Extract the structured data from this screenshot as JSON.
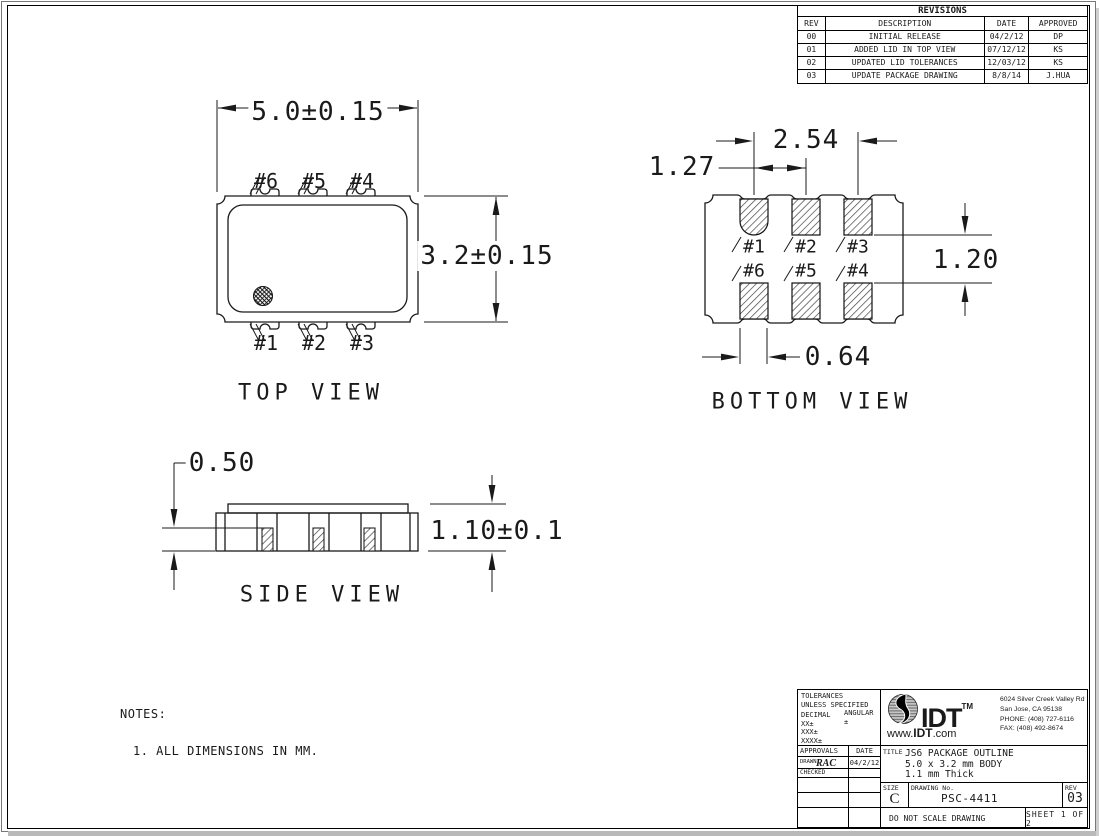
{
  "revisions": {
    "title": "REVISIONS",
    "headers": {
      "rev": "REV",
      "description": "DESCRIPTION",
      "date": "DATE",
      "approved": "APPROVED"
    },
    "rows": [
      {
        "rev": "00",
        "description": "INITIAL RELEASE",
        "date": "04/2/12",
        "approved": "DP"
      },
      {
        "rev": "01",
        "description": "ADDED LID IN TOP VIEW",
        "date": "07/12/12",
        "approved": "KS"
      },
      {
        "rev": "02",
        "description": "UPDATED LID TOLERANCES",
        "date": "12/03/12",
        "approved": "KS"
      },
      {
        "rev": "03",
        "description": "UPDATE PACKAGE DRAWING",
        "date": "8/8/14",
        "approved": "J.HUA"
      }
    ]
  },
  "views": {
    "top": {
      "label": "TOP VIEW",
      "dim_width": "5.0±0.15",
      "dim_height": "3.2±0.15",
      "pins_top": [
        "#6",
        "#5",
        "#4"
      ],
      "pins_bottom": [
        "#1",
        "#2",
        "#3"
      ]
    },
    "bottom": {
      "label": "BOTTOM VIEW",
      "dim_pitch_full": "2.54",
      "dim_pitch_half": "1.27",
      "dim_row_gap": "1.20",
      "dim_pad_width": "0.64",
      "pins_row1": [
        "#1",
        "#2",
        "#3"
      ],
      "pins_row2": [
        "#6",
        "#5",
        "#4"
      ]
    },
    "side": {
      "label": "SIDE VIEW",
      "dim_standoff": "0.50",
      "dim_height": "1.10±0.1"
    }
  },
  "notes": {
    "heading": "NOTES:",
    "item1": "1. ALL DIMENSIONS IN MM."
  },
  "title_block": {
    "tolerances": {
      "line1": "TOLERANCES",
      "line2": "UNLESS SPECIFIED",
      "decimal_label": "DECIMAL",
      "angular_label": "ANGULAR",
      "angular_value": "±",
      "row1": "XX±",
      "row2": "XXX±",
      "row3": "XXXX±"
    },
    "approvals": {
      "header": "APPROVALS",
      "date_header": "DATE",
      "drawn_label": "DRAWN",
      "drawn_signature": "RAC",
      "drawn_date": "04/2/12",
      "checked_label": "CHECKED"
    },
    "company": {
      "logo_text": "IDT",
      "trademark": "TM",
      "website_prefix": "www.",
      "website_bold": "IDT",
      "website_suffix": ".com",
      "address_line1": "6024 Silver Creek Valley Rd",
      "address_line2": "San Jose, CA 95138",
      "phone": "PHONE: (408) 727-6116",
      "fax": "FAX: (408) 492-8674"
    },
    "title": {
      "label": "TITLE",
      "line1": "JS6 PACKAGE OUTLINE",
      "line2": "5.0 x 3.2 mm BODY",
      "line3": "1.1 mm Thick"
    },
    "size": {
      "label": "SIZE",
      "value": "C"
    },
    "drawing_no": {
      "label": "DRAWING No.",
      "value": "PSC-4411"
    },
    "rev": {
      "label": "REV",
      "value": "03"
    },
    "footer": {
      "scale_note": "DO NOT SCALE DRAWING",
      "sheet": "SHEET 1 OF 2"
    }
  }
}
